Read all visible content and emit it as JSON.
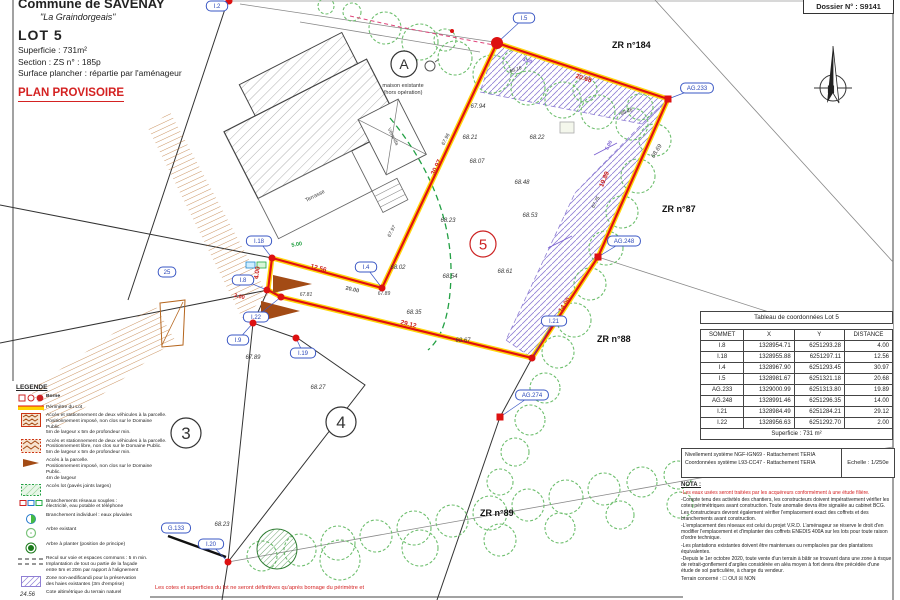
{
  "title_block": {
    "commune": "Commune de SAVENAY",
    "lieu_dit": "\"La Graindorgeais\"",
    "lot": "LOT 5",
    "superficie": "Superficie :  731m²",
    "section": "Section :  ZS      n° :  185p",
    "surface_plancher": "Surface plancher : répartie par l'aménageur",
    "plan_provisoire": "PLAN PROVISOIRE"
  },
  "dossier": "Dossier N° : S9141",
  "north": "N",
  "disclaimer": "Les cotes et superficies du lot ne seront définitives qu'après bornage du périmètre et",
  "coord_table": {
    "title": "Tableau de coordonnées Lot 5",
    "headers": [
      "SOMMET",
      "X",
      "Y",
      "DISTANCE"
    ],
    "rows": [
      [
        "I.8",
        "1328954.71",
        "6251293.28",
        "4.00"
      ],
      [
        "I.18",
        "1328955.88",
        "6251297.11",
        "12.56"
      ],
      [
        "I.4",
        "1328967.90",
        "6251293.45",
        "30.97"
      ],
      [
        "I.5",
        "1328981.67",
        "6251321.18",
        "20.68"
      ],
      [
        "AG.233",
        "1329000.99",
        "6251313.80",
        "19.89"
      ],
      [
        "AG.248",
        "1328991.46",
        "6251296.35",
        "14.00"
      ],
      [
        "I.21",
        "1328984.49",
        "6251284.21",
        "29.12"
      ],
      [
        "I.22",
        "1328956.63",
        "6251292.70",
        "2.00"
      ]
    ],
    "footer": "Superficie : 731 m²"
  },
  "ref_box": {
    "line1": "Nivellement système NGF-IGN69 - Rattachement TERIA",
    "line2": "Coordonnées système L93-CC47 - Rattachement TERIA",
    "echelle": "Echelle : 1/250e"
  },
  "nota": {
    "title": "NOTA :",
    "red_line": "-Les eaux usées seront traitées par les acquéreurs conformément à une étude filière.",
    "paragraphs": [
      "-Compte tenu des activités des chantiers, les constructeurs doivent impérativement vérifier les cotes périmétriques avant construction. Toute anomalie devra être signalée au cabinet BCG. Les constructeurs devront également vérifier l'emplacement exact des coffrets et des branchements avant construction.",
      "-L'emplacement des réseaux est celui du projet V.R.D. L'aménageur se réserve le droit d'en modifier l'emplacement et d'implanter des coffrets ENEDIS 400A sur les lots pour toute raison d'ordre technique.",
      "-Les plantations existantes doivent être maintenues ou remplacées par des plantations équivalentes.",
      "-Depuis le 1er octobre 2020, toute vente d'un terrain à bâtir se trouvant dans une zone à risque de retrait-gonflement d'argiles considérée en aléa moyen à fort devra être précédée d'une étude de sol particulière, à charge du vendeur."
    ],
    "terrain_line": "Terrain concerné :       ☐ OUI       ☒ NON"
  },
  "legend": {
    "title": "LEGENDE",
    "items": [
      {
        "icon": "borne",
        "bold": true,
        "lines": [
          "Borne"
        ]
      },
      {
        "icon": "perimetre",
        "lines": [
          "Périmètre du Lot"
        ]
      },
      {
        "icon": "acces-imposed",
        "lines": [
          "Accès et stationnement de deux véhicules à la parcelle.",
          "Positionnement imposé, non clos sur le Domaine Public.",
          "5m de largeur x 5m de profondeur min."
        ]
      },
      {
        "icon": "acces-libre",
        "lines": [
          "Accès et stationnement de deux véhicules à la parcelle.",
          "Positionnement libre, non clos sur le Domaine Public.",
          "5m de largeur x 5m de profondeur min."
        ]
      },
      {
        "icon": "acces-arrow",
        "lines": [
          "Accès à la parcelle.",
          "Positionnement imposé, non clos sur le Domaine Public.",
          "4m de largeur"
        ]
      },
      {
        "icon": "acces-lot",
        "lines": [
          "Accès lot (pavés joints larges)"
        ]
      },
      {
        "icon": "branchements",
        "lines": [
          "Branchements réseaux souples :",
          "électricité, eau potable et téléphone"
        ]
      },
      {
        "icon": "pluvial",
        "lines": [
          "Branchement individuel : eaux pluviales"
        ]
      },
      {
        "icon": "arbre-existant",
        "lines": [
          "Arbre existant"
        ]
      },
      {
        "icon": "arbre-planter",
        "lines": [
          "Arbre à planter (position de principe)"
        ]
      },
      {
        "icon": "recul",
        "lines": [
          "Recul sur voie et espaces communs : 5 m min.",
          "Implantation de tout ou partie de la façade",
          "entre 5m et 20m par rapport à l'alignement"
        ]
      },
      {
        "icon": "zone-non-aedificandi",
        "lines": [
          "Zone non-aedificandi pour la préservation",
          "des haies existantes (3m d'emprise)"
        ]
      },
      {
        "icon": "cote",
        "icon_text": "24.56",
        "lines": [
          "Cote altimétrique du terrain naturel"
        ]
      },
      {
        "icon": "pente",
        "icon_text": "2.0% 68.96",
        "lines": [
          "Pente et cote voirie projet"
        ]
      }
    ]
  },
  "plan": {
    "lot_number_color": "#cc2222",
    "boundary_colors": {
      "perimeter_red": "#e01010",
      "perimeter_yellow": "#ffd400"
    },
    "note_a": [
      "maison existante",
      "(hors opération)"
    ],
    "building": {
      "terrasse": "Terrasse",
      "veranda": "Véranda"
    },
    "zone_labels": [
      {
        "t": "ZR n°184",
        "x": 612,
        "y": 48
      },
      {
        "t": "ZR n°87",
        "x": 662,
        "y": 212
      },
      {
        "t": "ZR n°88",
        "x": 597,
        "y": 342
      },
      {
        "t": "ZR n°89",
        "x": 480,
        "y": 516
      }
    ],
    "circled_labels": [
      {
        "t": "A",
        "x": 404,
        "y": 64,
        "r": 13,
        "c": "#333333",
        "fs": 14
      },
      {
        "t": "3",
        "x": 186,
        "y": 433,
        "r": 15,
        "c": "#333333",
        "fs": 17
      },
      {
        "t": "4",
        "x": 341,
        "y": 422,
        "r": 15,
        "c": "#333333",
        "fs": 17
      },
      {
        "t": "5",
        "x": 483,
        "y": 244,
        "r": 13,
        "c": "#cc2222",
        "fs": 15
      }
    ],
    "bubbles": [
      {
        "label": "I.2",
        "x": 217,
        "y": 6,
        "px": 229,
        "py": 1,
        "marker": "dot"
      },
      {
        "label": "I.5",
        "x": 524,
        "y": 18,
        "px": 497,
        "py": 43,
        "marker": "bigdot"
      },
      {
        "label": "AG.233",
        "x": 697,
        "y": 88,
        "px": 668,
        "py": 99,
        "marker": "square"
      },
      {
        "label": "AG.248",
        "x": 624,
        "y": 241,
        "px": 598,
        "py": 257,
        "marker": "square"
      },
      {
        "label": "I.21",
        "x": 554,
        "y": 321,
        "px": 532,
        "py": 358,
        "marker": "dot"
      },
      {
        "label": "AG.274",
        "x": 532,
        "y": 395,
        "px": 500,
        "py": 417,
        "marker": "square"
      },
      {
        "label": "I.4",
        "x": 366,
        "y": 267,
        "px": 382,
        "py": 288,
        "marker": "dot"
      },
      {
        "label": "I.18",
        "x": 259,
        "y": 241,
        "px": 272,
        "py": 258,
        "marker": "dot"
      },
      {
        "label": "I.8",
        "x": 243,
        "y": 280,
        "px": 267,
        "py": 290,
        "marker": "dot"
      },
      {
        "label": "25",
        "x": 167,
        "y": 272
      },
      {
        "label": "I.22",
        "x": 256,
        "y": 317,
        "px": 281,
        "py": 297,
        "marker": "dot"
      },
      {
        "label": "I.9",
        "x": 238,
        "y": 340,
        "px": 253,
        "py": 323,
        "marker": "dot"
      },
      {
        "label": "I.19",
        "x": 303,
        "y": 353,
        "px": 296,
        "py": 338,
        "marker": "dot"
      },
      {
        "label": "G.133",
        "x": 176,
        "y": 528
      },
      {
        "label": "I.20",
        "x": 211,
        "y": 544,
        "px": 228,
        "py": 562,
        "marker": "dot"
      }
    ],
    "elevations": [
      {
        "t": "67.94",
        "x": 478,
        "y": 108
      },
      {
        "t": "68.21",
        "x": 470,
        "y": 139
      },
      {
        "t": "68.22",
        "x": 537,
        "y": 139
      },
      {
        "t": "68.07",
        "x": 477,
        "y": 163
      },
      {
        "t": "68.48",
        "x": 522,
        "y": 184
      },
      {
        "t": "68.53",
        "x": 530,
        "y": 217
      },
      {
        "t": "68.23",
        "x": 448,
        "y": 222
      },
      {
        "t": "68.02",
        "x": 398,
        "y": 269
      },
      {
        "t": "68.54",
        "x": 450,
        "y": 278
      },
      {
        "t": "68.61",
        "x": 505,
        "y": 273
      },
      {
        "t": "68.35",
        "x": 414,
        "y": 314
      },
      {
        "t": "68.67",
        "x": 463,
        "y": 342
      },
      {
        "t": "67.81",
        "x": 306,
        "y": 296,
        "s": 5
      },
      {
        "t": "67.89",
        "x": 384,
        "y": 295,
        "s": 5
      },
      {
        "t": "67.89",
        "x": 253,
        "y": 359
      },
      {
        "t": "68.27",
        "x": 318,
        "y": 389
      },
      {
        "t": "68.23",
        "x": 222,
        "y": 526
      },
      {
        "t": "67.96",
        "x": 447,
        "y": 140,
        "r": -63,
        "s": 5
      },
      {
        "t": "67.97",
        "x": 393,
        "y": 232,
        "r": -63,
        "s": 5
      },
      {
        "t": "68.69",
        "x": 658,
        "y": 152,
        "r": -58
      },
      {
        "t": "68.16",
        "x": 516,
        "y": 71,
        "r": -18,
        "s": 5
      },
      {
        "t": "68.46",
        "x": 627,
        "y": 113,
        "r": -20,
        "s": 5
      },
      {
        "t": "67.75",
        "x": 597,
        "y": 203,
        "r": -62,
        "s": 5
      }
    ],
    "measurements": [
      {
        "t": "30.97",
        "x": 438,
        "y": 168,
        "r": -64
      },
      {
        "t": "20.68",
        "x": 583,
        "y": 80,
        "r": 17
      },
      {
        "t": "19.89",
        "x": 606,
        "y": 180,
        "r": -67
      },
      {
        "t": "14.00",
        "x": 566,
        "y": 306,
        "r": -56
      },
      {
        "t": "29.12",
        "x": 408,
        "y": 326,
        "r": 14
      },
      {
        "t": "12.56",
        "x": 318,
        "y": 270,
        "r": 15
      },
      {
        "t": "4.00",
        "x": 259,
        "y": 273,
        "r": -83
      },
      {
        "t": "2.00",
        "x": 239,
        "y": 298,
        "r": 14,
        "s": 5.5
      },
      {
        "t": "5.00",
        "x": 297,
        "y": 246,
        "r": -10,
        "c": "#1e9e3e",
        "s": 5.5
      },
      {
        "t": "20.00",
        "x": 352,
        "y": 291,
        "r": 13,
        "c": "#555555",
        "s": 5.5
      },
      {
        "t": "5.00",
        "x": 610,
        "y": 146,
        "r": -62,
        "c": "#7a5fd0",
        "s": 5
      },
      {
        "t": "3.00",
        "x": 527,
        "y": 62,
        "r": 17,
        "c": "#7a5fd0",
        "s": 5
      }
    ]
  }
}
